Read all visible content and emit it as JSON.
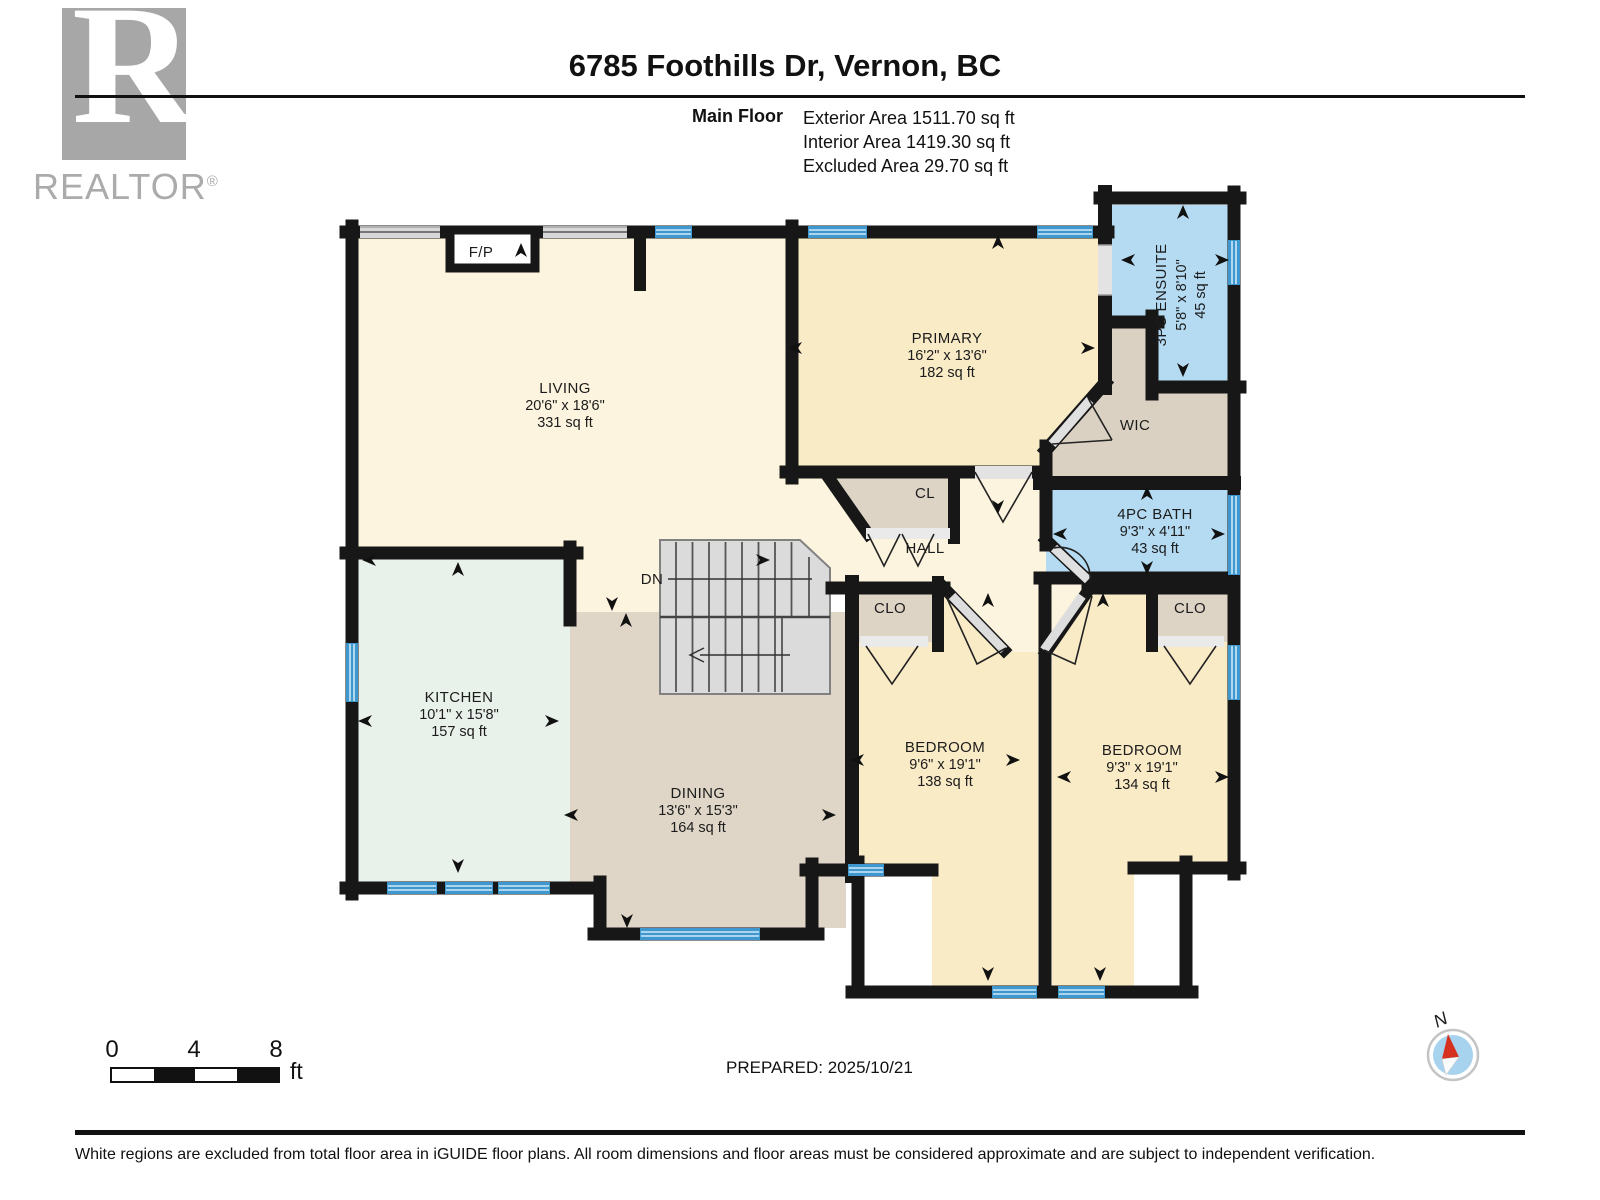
{
  "header": {
    "title": "6785 Foothills Dr, Vernon, BC",
    "floor_label": "Main Floor",
    "stats": [
      "Exterior Area 1511.70 sq ft",
      "Interior Area 1419.30 sq ft",
      "Excluded Area 29.70 sq ft"
    ]
  },
  "logo": {
    "letter": "R",
    "brand": "REALTOR",
    "reg": "®"
  },
  "rooms": {
    "living": {
      "name": "LIVING",
      "dims": "20'6\" x 18'6\"",
      "area": "331 sq ft"
    },
    "kitchen": {
      "name": "KITCHEN",
      "dims": "10'1\" x 15'8\"",
      "area": "157 sq ft"
    },
    "dining": {
      "name": "DINING",
      "dims": "13'6\" x 15'3\"",
      "area": "164 sq ft"
    },
    "primary": {
      "name": "PRIMARY",
      "dims": "16'2\" x 13'6\"",
      "area": "182 sq ft"
    },
    "ensuite": {
      "name": "3PC ENSUITE",
      "dims": "5'8\" x 8'10\"",
      "area": "45 sq ft"
    },
    "bath": {
      "name": "4PC BATH",
      "dims": "9'3\" x 4'11\"",
      "area": "43 sq ft"
    },
    "bedroom_left": {
      "name": "BEDROOM",
      "dims": "9'6\" x 19'1\"",
      "area": "138 sq ft"
    },
    "bedroom_right": {
      "name": "BEDROOM",
      "dims": "9'3\" x 19'1\"",
      "area": "134 sq ft"
    },
    "wic": {
      "name": "WIC"
    },
    "hall": {
      "name": "HALL"
    }
  },
  "labels": {
    "fireplace": "F/P",
    "stairs_down": "DN",
    "closet_hall": "CL",
    "closet_bed_left": "CLO",
    "closet_bed_right": "CLO"
  },
  "scale": {
    "ticks": [
      "0",
      "4",
      "8"
    ],
    "unit": "ft"
  },
  "prepared": "PREPARED: 2025/10/21",
  "compass_north": "N",
  "footer": "White regions are excluded from total floor area in iGUIDE floor plans. All room dimensions and floor areas must be considered approximate and are subject to independent verification.",
  "colors": {
    "wall": "#171717",
    "cream_light": "#FCF4DE",
    "cream": "#FAEBC7",
    "kitchen": "#E9F1EB",
    "tan": "#DFD6C7",
    "closet": "#DDD4C5",
    "bath_blue": "#B5DBF2",
    "window_blue": "#3E97CF",
    "window_gray": "#D8D8D8",
    "stairs": "#DBDBDB",
    "compass_red": "#D6301E",
    "compass_blue": "#A8D3EE"
  }
}
